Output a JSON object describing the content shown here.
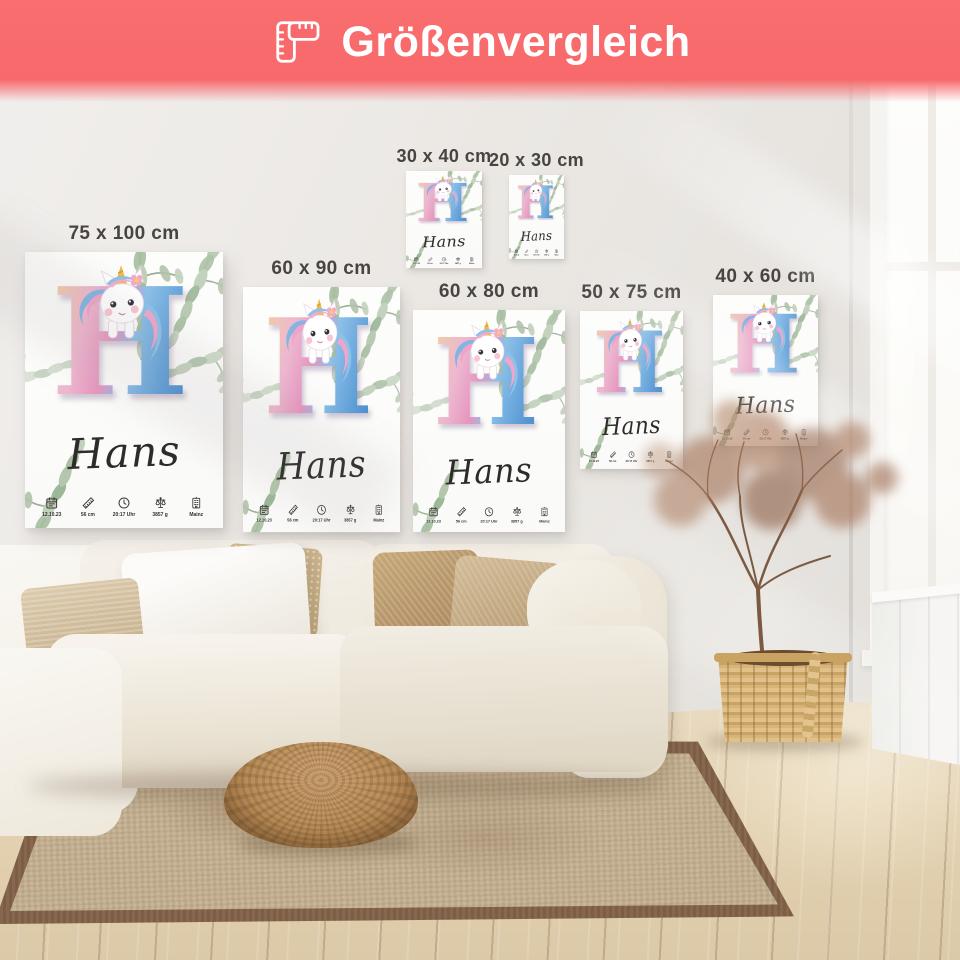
{
  "header": {
    "title": "Größenvergleich",
    "icon": "folding-ruler-icon",
    "background_color": "#f8696b",
    "text_color": "#ffffff"
  },
  "sizes": [
    {
      "id": "75x100",
      "label": "75 x 100 cm"
    },
    {
      "id": "60x90",
      "label": "60 x 90 cm"
    },
    {
      "id": "30x40",
      "label": "30 x 40 cm"
    },
    {
      "id": "20x30",
      "label": "20 x 30 cm"
    },
    {
      "id": "60x80",
      "label": "60 x 80 cm"
    },
    {
      "id": "50x75",
      "label": "50 x 75 cm"
    },
    {
      "id": "40x60",
      "label": "40 x 60 cm"
    }
  ],
  "poster": {
    "letter": "H",
    "name": "Hans",
    "stats": [
      {
        "icon": "calendar-icon",
        "label": "12.10.23"
      },
      {
        "icon": "ruler-icon",
        "label": "56 cm"
      },
      {
        "icon": "clock-icon",
        "label": "20:17 Uhr"
      },
      {
        "icon": "scale-icon",
        "label": "3857 g"
      },
      {
        "icon": "building-icon",
        "label": "Mainz"
      }
    ]
  },
  "colors": {
    "accent": "#f8696b",
    "letter_gradient_left": "#f1d49c",
    "letter_gradient_pink": "#e795bf",
    "letter_gradient_right": "#3d7fc2",
    "eucalyptus": "#aec2a8",
    "poster_background": "#fdfdfc"
  }
}
